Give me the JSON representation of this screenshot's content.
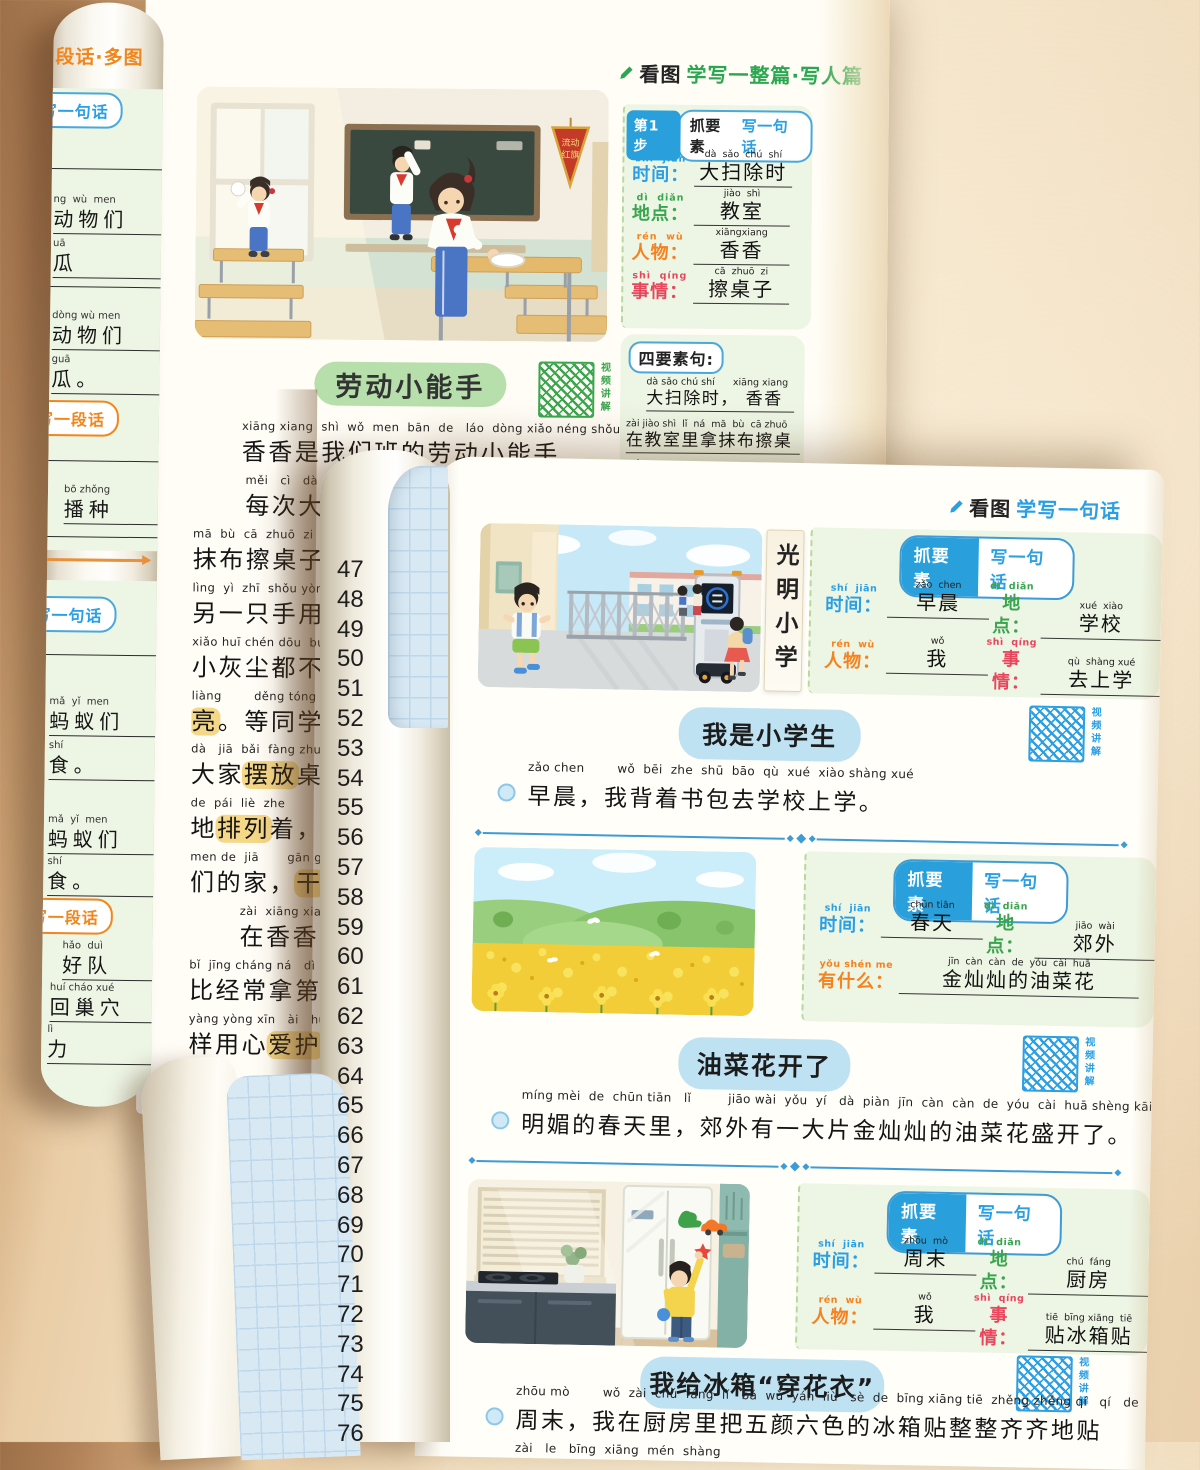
{
  "colors": {
    "blue": "#2b9fe3",
    "green": "#3aa54f",
    "orange": "#f5821f",
    "red": "#e8465c",
    "badge_blue": "#29a0dc",
    "divider": "#3d9bd5",
    "title_green_bg": "#b7dfac",
    "title_blue_bg": "#bfe2f3",
    "highlight": "#f5d788",
    "panel_green": "#edf5e4",
    "header_green": "#2aa84f"
  },
  "left_roll": {
    "header": "段话·多图",
    "items": [
      {
        "type": "pill-blue",
        "text": "写一句话",
        "y": 90
      },
      {
        "type": "line",
        "y": 166
      },
      {
        "type": "text",
        "hanzi": "动物们",
        "pinyin": "ng  wù  men",
        "y": 192,
        "x": 2
      },
      {
        "type": "text",
        "hanzi": "瓜",
        "pinyin": "uā",
        "y": 236,
        "x": 2
      },
      {
        "type": "line",
        "y": 284
      },
      {
        "type": "text",
        "hanzi": "动物们",
        "pinyin": "dòng wù men",
        "y": 308,
        "x": 2
      },
      {
        "type": "text",
        "hanzi": "瓜。",
        "pinyin": "guā",
        "y": 352,
        "x": 2
      },
      {
        "type": "pill-orange",
        "text": "写一段话",
        "y": 398
      },
      {
        "type": "line",
        "y": 458
      },
      {
        "type": "text",
        "hanzi": "播种",
        "pinyin": "bō zhǒng",
        "y": 482,
        "x": 16
      },
      {
        "type": "line",
        "y": 534
      },
      {
        "type": "arrow",
        "y": 556
      },
      {
        "type": "pill-blue",
        "text": "写一句话",
        "y": 594
      },
      {
        "type": "line",
        "y": 652
      },
      {
        "type": "text",
        "hanzi": "蚂蚁们",
        "pinyin": "mǎ  yǐ  men",
        "y": 694,
        "x": 4
      },
      {
        "type": "text",
        "hanzi": "食。",
        "pinyin": "shí",
        "y": 738,
        "x": 4
      },
      {
        "type": "text",
        "hanzi": "蚂蚁们",
        "pinyin": "mǎ  yǐ  men",
        "y": 812,
        "x": 4
      },
      {
        "type": "text",
        "hanzi": "食。",
        "pinyin": "shí",
        "y": 854,
        "x": 4
      },
      {
        "type": "pill-orange",
        "text": "写一段话",
        "y": 896
      },
      {
        "type": "text",
        "hanzi": "好队",
        "pinyin": "hǎo  duì",
        "y": 938,
        "x": 20
      },
      {
        "type": "text",
        "hanzi": "回巢穴",
        "pinyin": "huí cháo xué",
        "y": 980,
        "x": 8
      },
      {
        "type": "text",
        "hanzi": "力",
        "pinyin": "lì",
        "y": 1022,
        "x": 6
      }
    ]
  },
  "back_page": {
    "header_black": "看图",
    "header_green": "学写一整篇·写人篇",
    "video_label": "视频讲解",
    "step_badge": {
      "step": "第1步",
      "mid": "抓要素",
      "right": "写一句话"
    },
    "fields": [
      {
        "pinyin": "shí  jiān",
        "label": "时间",
        "color": "#2b9fe3",
        "value_pinyin": "dà  sǎo  chú  shí",
        "value": "大扫除时"
      },
      {
        "pinyin": "dì  diǎn",
        "label": "地点",
        "color": "#3aa54f",
        "value_pinyin": "jiào  shì",
        "value": "教室"
      },
      {
        "pinyin": "rén  wù",
        "label": "人物",
        "color": "#f5821f",
        "value_pinyin": "xiāngxiang",
        "value": "香香"
      },
      {
        "pinyin": "shì  qíng",
        "label": "事情",
        "color": "#e8465c",
        "value_pinyin": "cā  zhuō  zi",
        "value": "擦桌子"
      }
    ],
    "four_panel": {
      "label": "四要素句:",
      "lines": [
        {
          "pinyin": "dà sǎo chú shí      xiāng xiang",
          "text": "大扫除时， 香香"
        },
        {
          "pinyin": "zài jiào shì  lǐ  ná  mā  bù  cā zhuō",
          "text": "在教室里拿抹布擦桌"
        },
        {
          "pinyin": "zi",
          "text": "子"
        }
      ]
    },
    "title": "劳动小能手",
    "body_lines": [
      {
        "pinyin": "xiāng xiang  shì  wǒ  men  bān  de   láo  dòng xiǎo néng shǒu",
        "indent": 48,
        "w": 470,
        "segs": [
          {
            "t": "香香是我们班的劳动小能手"
          }
        ]
      },
      {
        "pinyin": "měi   cì   dà  sǎo",
        "indent": 52,
        "w": 430,
        "segs": [
          {
            "t": "每次大扫"
          }
        ]
      },
      {
        "pinyin": "mā  bù  cā  zhuō  zi",
        "indent": 0,
        "w": 150,
        "segs": [
          {
            "t": "抹布擦桌子"
          }
        ]
      },
      {
        "pinyin": "lìng  yì  zhī  shǒu yòng",
        "indent": 0,
        "w": 150,
        "segs": [
          {
            "t": "另一只手用"
          }
        ]
      },
      {
        "pinyin": "xiǎo huī chén dōu  bú  f",
        "indent": 0,
        "w": 150,
        "segs": [
          {
            "t": "小灰尘都不"
          }
        ]
      },
      {
        "pinyin": "liàng        děng tóng xué",
        "indent": 0,
        "w": 150,
        "segs": [
          {
            "t": "亮",
            "hl": true
          },
          {
            "t": "。等同学"
          }
        ]
      },
      {
        "pinyin": "dà   jiā  bǎi  fàng zhuō",
        "indent": 0,
        "w": 150,
        "segs": [
          {
            "t": "大家"
          },
          {
            "t": "摆放",
            "hl": true
          },
          {
            "t": "桌"
          }
        ]
      },
      {
        "pinyin": "de  pái  liè  zhe",
        "indent": 0,
        "w": 150,
        "segs": [
          {
            "t": "地"
          },
          {
            "t": "排列",
            "hl": true
          },
          {
            "t": "着，"
          }
        ]
      },
      {
        "pinyin": "men de  jiā       gān g",
        "indent": 0,
        "w": 150,
        "segs": [
          {
            "t": "们的家，"
          },
          {
            "t": "干",
            "hl": true
          }
        ]
      },
      {
        "pinyin": "zài  xiāng xiang",
        "indent": 50,
        "w": 104,
        "segs": [
          {
            "t": "在香香"
          }
        ]
      },
      {
        "pinyin": "bǐ  jīng cháng ná   dì",
        "indent": 0,
        "w": 150,
        "segs": [
          {
            "t": "比经常拿第"
          }
        ]
      },
      {
        "pinyin": "yàng yòng xīn   ài   hù",
        "indent": 0,
        "w": 150,
        "segs": [
          {
            "t": "样用心"
          },
          {
            "t": "爱护",
            "hl": true
          }
        ]
      }
    ],
    "line_numbers": [
      47,
      48,
      49,
      50,
      51,
      52,
      53,
      54,
      55,
      56,
      57,
      58,
      59,
      60,
      61,
      62,
      63,
      64,
      65,
      66,
      67,
      68,
      69,
      70,
      71,
      72,
      73,
      74,
      75,
      76
    ]
  },
  "front_page": {
    "header_black": "看图",
    "header_blue": "学写一句话",
    "video_label": "视频讲解",
    "badge_left": "抓要素",
    "badge_right": "写一句话",
    "sections": [
      {
        "illustration": "school-gate",
        "sign": "光明小学",
        "fields": [
          {
            "pinyin": "shí  jiān",
            "label": "时间",
            "color": "#2b9fe3",
            "value_pinyin": "zǎo  chen",
            "value": "早晨"
          },
          {
            "pinyin": "dì  diǎn",
            "label": "地点",
            "color": "#3aa54f",
            "value_pinyin": "xué  xiào",
            "value": "学校"
          },
          {
            "pinyin": "rén  wù",
            "label": "人物",
            "color": "#f5821f",
            "value_pinyin": "wǒ",
            "value": "我"
          },
          {
            "pinyin": "shì  qíng",
            "label": "事情",
            "color": "#e8465c",
            "value_pinyin": "qù  shàng xué",
            "value": "去上学"
          }
        ],
        "title": "我是小学生",
        "sentence_pinyin": "zǎo chen        wǒ  bēi  zhe  shū  bāo  qù  xué  xiào shàng xué",
        "sentence": "早晨，我背着书包去学校上学。"
      },
      {
        "illustration": "flower-field",
        "fields": [
          {
            "pinyin": "shí  jiān",
            "label": "时间",
            "color": "#2b9fe3",
            "value_pinyin": "chūn tiān",
            "value": "春天"
          },
          {
            "pinyin": "dì  diǎn",
            "label": "地点",
            "color": "#3aa54f",
            "value_pinyin": "jiāo  wài",
            "value": "郊外"
          },
          {
            "pinyin": "yǒu shén me",
            "label": "有什么",
            "color": "#f5821f",
            "value_pinyin": "jīn  càn  càn  de  yóu  cài  huā",
            "value": "金灿灿的油菜花",
            "wide": true
          }
        ],
        "title": "油菜花开了",
        "sentence_pinyin": "míng mèi  de  chūn tiān   lǐ         jiāo wài  yǒu  yí   dà  piàn  jīn  càn  càn  de  yóu  cài  huā shèng kāi   le",
        "sentence": "明媚的春天里，郊外有一大片金灿灿的油菜花盛开了。"
      },
      {
        "illustration": "kitchen-fridge",
        "fields": [
          {
            "pinyin": "shí  jiān",
            "label": "时间",
            "color": "#2b9fe3",
            "value_pinyin": "zhōu  mò",
            "value": "周末"
          },
          {
            "pinyin": "dì  diǎn",
            "label": "地点",
            "color": "#3aa54f",
            "value_pinyin": "chú  fáng",
            "value": "厨房"
          },
          {
            "pinyin": "rén  wù",
            "label": "人物",
            "color": "#f5821f",
            "value_pinyin": "wǒ",
            "value": "我"
          },
          {
            "pinyin": "shì  qíng",
            "label": "事情",
            "color": "#e8465c",
            "value_pinyin": "tiē  bīng xiāng  tiē",
            "value": "贴冰箱贴"
          }
        ],
        "title": "我给冰箱“穿花衣”",
        "sentence_pinyin": "zhōu mò        wǒ  zài  chú  fáng  lǐ   bǎ  wǔ  yán  liù   sè  de  bīng xiāng tiē  zhěng zhěng qí   qí   de  tiē",
        "sentence": "周末，我在厨房里把五颜六色的冰箱贴整整齐齐地贴",
        "overflow_pinyin": "zài   le   bīng  xiāng  mén  shàng"
      }
    ]
  }
}
